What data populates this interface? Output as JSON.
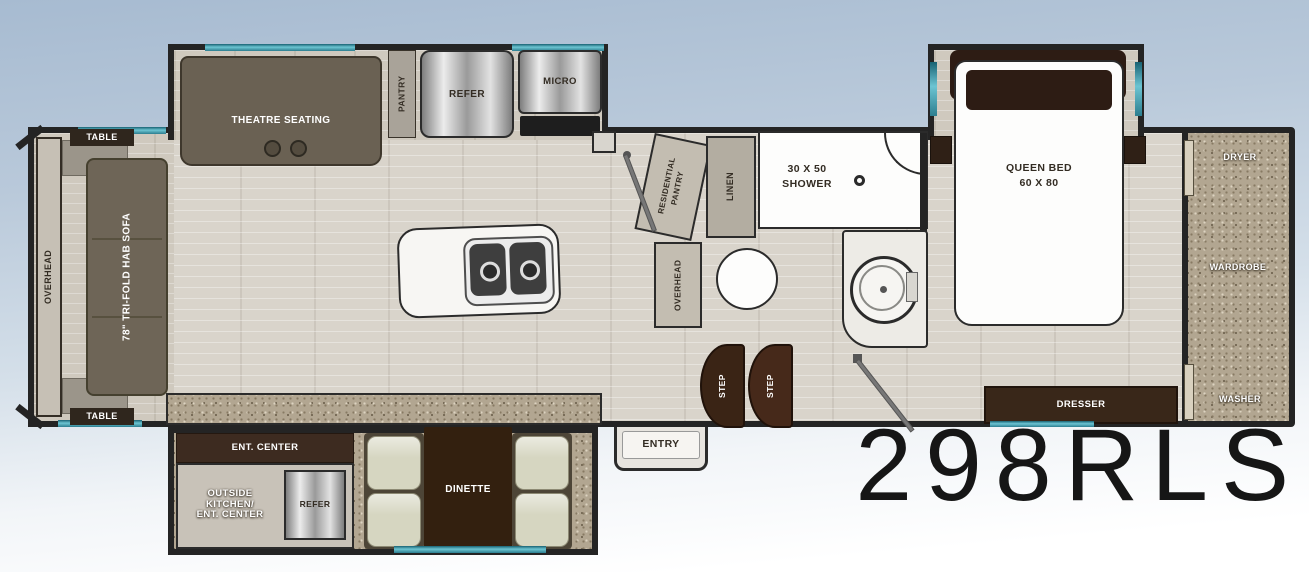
{
  "model_number": "298RLS",
  "front_slide": {
    "table_top": "TABLE",
    "table_bottom": "TABLE",
    "overhead": "OVERHEAD",
    "sofa": "78\" TRI-FOLD HAB SOFA"
  },
  "galley": {
    "theatre_seating": "THEATRE SEATING",
    "pantry": "PANTRY",
    "refrigerator": "REFER",
    "microwave": "MICRO"
  },
  "bath": {
    "residential_pantry_line1": "RESIDENTIAL",
    "residential_pantry_line2": "PANTRY",
    "overhead": "OVERHEAD",
    "linen": "LINEN",
    "shower_size": "30 X 50",
    "shower": "SHOWER",
    "step_front": "STEP",
    "step_rear": "STEP",
    "entry": "ENTRY"
  },
  "bedroom": {
    "bed_type": "QUEEN BED",
    "bed_size": "60 X 80",
    "dresser": "DRESSER"
  },
  "rear_closet": {
    "dryer": "DRYER",
    "wardrobe": "WARDROBE",
    "washer": "WASHER"
  },
  "bottom_slide": {
    "ent_center": "ENT. CENTER",
    "outside_kitchen_line1": "OUTSIDE",
    "outside_kitchen_line2": "KITCHEN/",
    "outside_kitchen_line3": "ENT. CENTER",
    "refrigerator": "REFER",
    "dinette": "DINETTE"
  },
  "colors": {
    "accent_teal": "#3e93a2",
    "wall": "#242424",
    "wood_furniture": "#3a2a1e",
    "floor": "#d8d3ca"
  }
}
